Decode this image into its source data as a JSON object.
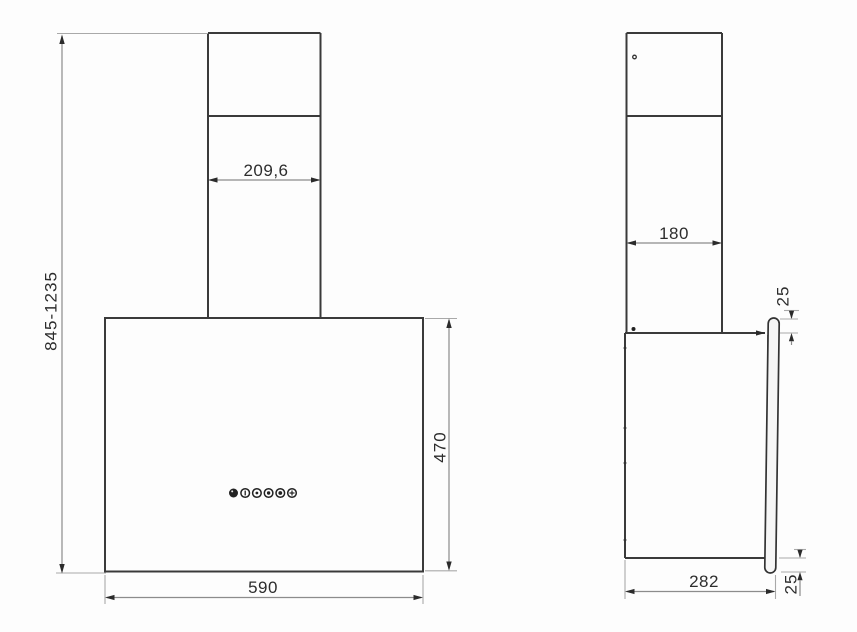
{
  "views": {
    "front": {
      "dims": {
        "height_range": "845-1235",
        "chimney_width": "209,6",
        "body_width": "590",
        "body_height": "470"
      },
      "controls": [
        "power-icon",
        "speed-1-icon",
        "speed-2-icon",
        "speed-3-icon",
        "boost-icon",
        "light-icon"
      ]
    },
    "side": {
      "dims": {
        "chimney_depth": "180",
        "glass_top_overhang": "25",
        "body_depth": "282",
        "glass_bottom_overhang": "25"
      }
    }
  },
  "colors": {
    "line": "#3a3a3a",
    "dimension_line": "#8c8c8c",
    "text": "#2d2d2d",
    "background": "#fdfdfd"
  }
}
